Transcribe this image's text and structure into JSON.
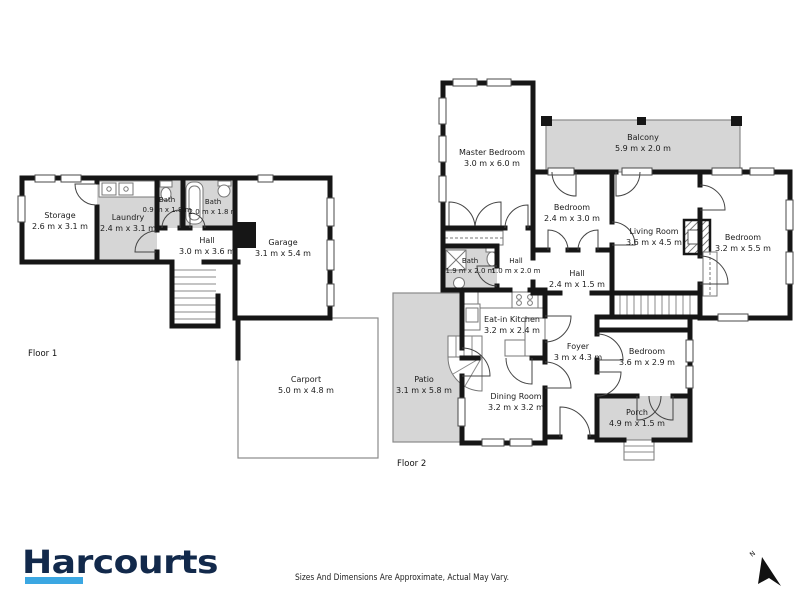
{
  "brand": {
    "name": "Harcourts"
  },
  "footer": {
    "disclaimer": "Sizes And Dimensions Are Approximate, Actual May Vary."
  },
  "north": {
    "label": "N"
  },
  "colors": {
    "wall": "#161616",
    "room_fill": "#d6d6d6",
    "brand_navy": "#12294b",
    "accent_blue": "#3ba7e2"
  },
  "floor1": {
    "label": "Floor 1",
    "rooms": [
      {
        "name": "Storage",
        "dims": "2.6 m x 3.1 m"
      },
      {
        "name": "Laundry",
        "dims": "2.4 m x 3.1 m"
      },
      {
        "name": "Bath",
        "dims": "0.9 m x 1.8 m"
      },
      {
        "name": "Bath",
        "dims": "2.0 m x 1.8 m"
      },
      {
        "name": "Hall",
        "dims": "3.0 m x 3.6 m"
      },
      {
        "name": "Garage",
        "dims": "3.1 m x 5.4 m"
      },
      {
        "name": "Carport",
        "dims": "5.0 m x 4.8 m"
      }
    ]
  },
  "floor2": {
    "label": "Floor 2",
    "rooms": [
      {
        "name": "Master Bedroom",
        "dims": "3.0 m x 6.0 m"
      },
      {
        "name": "Balcony",
        "dims": "5.9 m x 2.0 m"
      },
      {
        "name": "Bedroom",
        "dims": "2.4 m x 3.0 m"
      },
      {
        "name": "Living Room",
        "dims": "3.6 m x 4.5 m"
      },
      {
        "name": "Bedroom",
        "dims": "3.2 m x 5.5 m"
      },
      {
        "name": "Bath",
        "dims": "1.9 m x 2.0 m"
      },
      {
        "name": "Hall",
        "dims": "1.0 m x 2.0 m"
      },
      {
        "name": "Hall",
        "dims": "2.4 m x 1.5 m"
      },
      {
        "name": "Eat-in Kitchen",
        "dims": "3.2 m x 2.4 m"
      },
      {
        "name": "Foyer",
        "dims": "3 m x 4.3 m"
      },
      {
        "name": "Bedroom",
        "dims": "3.6 m x 2.9 m"
      },
      {
        "name": "Dining Room",
        "dims": "3.2 m x 3.2 m"
      },
      {
        "name": "Porch",
        "dims": "4.9 m x 1.5 m"
      },
      {
        "name": "Patio",
        "dims": "3.1 m x 5.8 m"
      }
    ]
  }
}
